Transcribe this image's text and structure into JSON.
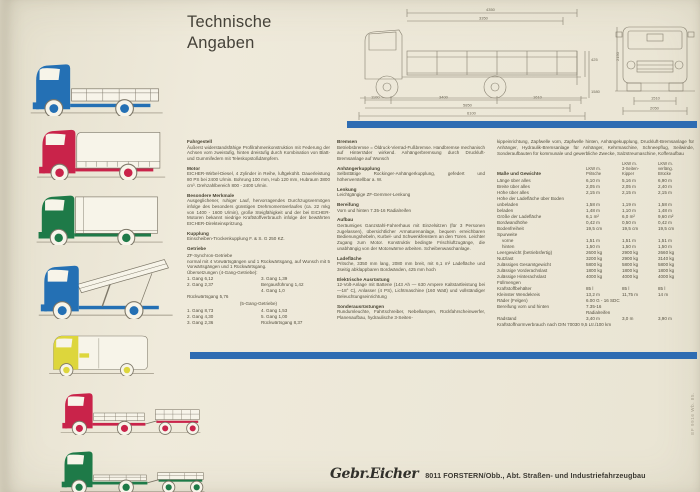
{
  "title": {
    "line1": "Technische",
    "line2": "Angaben"
  },
  "colors": {
    "blue": "#2470b4",
    "red": "#c9234a",
    "green": "#1e7a48",
    "yellow": "#ddd63c",
    "bar_blue": "#2e6cb2"
  },
  "trucks": [
    {
      "name": "Pritschenwagen",
      "color": "#2470b4"
    },
    {
      "name": "Planenwagen",
      "color": "#c9234a"
    },
    {
      "name": "Kofferwagen",
      "color": "#1e7a48"
    },
    {
      "name": "Dreiseitenkipper",
      "color": "#2470b4"
    },
    {
      "name": "Kastenwagen",
      "color": "#ddd63c"
    },
    {
      "name": "Pritschenzug",
      "color": "#c9234a"
    },
    {
      "name": "Plattformzug",
      "color": "#1e7a48"
    }
  ],
  "drawing": {
    "dims": {
      "top1": "4350",
      "top2": "3350",
      "side1": "425",
      "side2": "1580",
      "b1": "1100",
      "b2": "3400",
      "b3": "1610",
      "b4": "5850",
      "b5": "6100",
      "f_height": "2150",
      "f_track": "1510",
      "f_width": "2050"
    }
  },
  "col1": {
    "fahrgestell": {
      "heading": "Fahrgestell",
      "body": "Äußerst widerstandsfähige Profilrahmenkonstruktion mit Federung der Achsen vorn zweistufig, hinten dreistufig durch Kombination von Blatt- und Gummifedern mit Teleskopstoßdämpfern."
    },
    "motor": {
      "heading": "Motor",
      "body": "EICHER-Wirbel-Diesel, 4 Zylinder in Reihe, luftgekühlt. Dauerleistung 80 PS bei 2400 U/min. Bohrung 100 mm, Hub 120 mm, Hubraum 3800 cm³. Drehzahlbereich 800 - 2400 U/min."
    },
    "merkmale": {
      "heading": "Besondere Merkmale",
      "body": "Ausgeglichener, ruhiger Lauf, hervorragendes Durchzugsvermögen infolge des besonders günstigen Drehmomentverlaufes (ca. 22 mkg von 1400 - 1600 U/min), große Steigfähigkeit und der bei EICHER-Motoren bekannt niedrige Kraftstoffverbrauch infolge der bewährten EICHER-Direkteinspritzung."
    },
    "kupplung": {
      "heading": "Kupplung",
      "body": "Einscheiben-Trockenkupplung F. & S. G 250 KZ."
    },
    "getriebe": {
      "heading": "Getriebe",
      "intro1": "ZF-Synchron-Getriebe",
      "intro2": "normal mit 4 Vorwärtsgängen und 1 Rückwärtsgang, auf Wunsch mit 5 Vorwärtsgängen und 1 Rückwärtsgang.",
      "intro3": "Übersetzungen (4-Gang-Getriebe):",
      "g4_left": [
        "1. Gang 6,12",
        "2. Gang 2,37"
      ],
      "g4_right": [
        "3. Gang 1,39",
        "Bergausführung 1,42",
        "4. Gang 1,0"
      ],
      "reverse4": "Rückwärtsgang 5,76",
      "label5": "(5-Gang-Getriebe)",
      "g5_left": [
        "1. Gang 8,73",
        "2. Gang 4,30",
        "3. Gang 2,36"
      ],
      "g5_right": [
        "4. Gang 1,53",
        "5. Gang 1,00",
        "Rückwärtsgang 8,37"
      ]
    }
  },
  "col2": {
    "bremsen": {
      "heading": "Bremsen",
      "body": "Betriebsbremse = Öldruck-Vierrad-Fußbremse. Handbremse mechanisch auf Hinterräder wirkend. Anhängerbremsung durch Druckluft-Bremsanlage auf Wunsch"
    },
    "anhaengerkupplung": {
      "heading": "Anhängerkupplung",
      "body": "Selbsttätige Rockinger-Anhängerkupplung, gefedert und höhenverstellbar a. W."
    },
    "lenkung": {
      "heading": "Lenkung",
      "body": "Leichtgängige ZF-Gemmer-Lenkung"
    },
    "bereifung": {
      "heading": "Bereifung",
      "body": "Vorn und hinten 7.35-16 Radialreifen"
    },
    "aufbau": {
      "heading": "Aufbau",
      "body": "Geräumiges Ganzstahl-Fahrerhaus mit Einzelsitzen (für 3 Personen zugelassen), übersichtlicher Armaturenanlage, bequem erreichbaren Bedienungshebeln, Kurbel- und Schwenkfenstern an den Türen. Leichter Zugang zum Motor. Konstruktiv bedingte Frischluftzugänge, die unabhängig von der Motorwärme arbeiten. Scheibenwaschanlage."
    },
    "ladeflaeche": {
      "heading": "Ladefläche",
      "body": "Pritsche, 3350 mm lang, 2080 mm breit, mit 6,1 m² Ladefläche und 3seitig abklappbaren Bordwänden, 425 mm hoch"
    },
    "elektrik": {
      "heading": "Elektrische Ausrüstung",
      "body": "12-Volt-Anlage mit Batterie (143 Ah — 630 Ampere Kaltstartleistung bei —18° C), Anlasser (4 PS), Lichtmaschine (160 Watt) und vollständiger Beleuchtungseinrichtung"
    },
    "sonder": {
      "heading": "Sonderausrüstungen",
      "body": "Rundumleuchte, Fahrtschreiber, Nebellampen, Rückfahrscheinwerfer, Planenaufbau, hydraulische 3-Seiten-"
    }
  },
  "col3": {
    "continuation": "kippeinrichtung, Zapfwelle vorn, Zapfwelle hinten, Anhängekupplung, Druckluft-Bremsanlage für Anhänger, Hydraulik-Bremsanlage für Anhänger, Kehrmaschine, Schneepflug, Seilwinde, Sonderaufbauten für kommunale und gewerbliche Zwecke, Salzstreumaschine, Kofferaufbau",
    "table": {
      "section_title": "Maße und Gewichte",
      "headers": [
        "LKW m.\nPritsche",
        "LKW m.\n3-Seiten-\nKipper",
        "LKW m.\nverläng.\nBrücke"
      ],
      "rows": [
        {
          "l": "Länge über alles",
          "v": [
            "6,10 m",
            "5,16 m",
            "6,90 m"
          ]
        },
        {
          "l": "Breite über alles",
          "v": [
            "2,05 m",
            "2,05 m",
            "2,40 m"
          ]
        },
        {
          "l": "Höhe über alles",
          "v": [
            "2,15 m",
            "2,15 m",
            "2,15 m"
          ]
        },
        {
          "l": "Höhe der Ladefläche über Boden",
          "v": [
            "",
            "",
            ""
          ]
        },
        {
          "l": "unbeladen",
          "v": [
            "1,58 m",
            "1,19 m",
            "1,58 m"
          ]
        },
        {
          "l": "beladen",
          "v": [
            "1,48 m",
            "1,10 m",
            "1,48 m"
          ]
        },
        {
          "l": "Größe der Ladefläche",
          "v": [
            "6,1 m²",
            "6,0 m²",
            "9,60 m²"
          ]
        },
        {
          "l": "Bordwandhöhe",
          "v": [
            "0,42 m",
            "0,50 m",
            "0,42 m"
          ]
        },
        {
          "l": "Bodenfreiheit",
          "v": [
            "19,5 cm",
            "19,5 cm",
            "19,5 cm"
          ]
        },
        {
          "l": "Spurweite",
          "v": [
            "",
            "",
            ""
          ]
        },
        {
          "l": "vorne",
          "v": [
            "1,51 m",
            "1,51 m",
            "1,51 m"
          ],
          "indent": true
        },
        {
          "l": "hinten",
          "v": [
            "1,50 m",
            "1,50 m",
            "1,50 m"
          ],
          "indent": true
        },
        {
          "l": "Leergewicht (betriebsfertig)",
          "v": [
            "2600 kg",
            "2900 kg",
            "2660 kg"
          ]
        },
        {
          "l": "Nutzlast",
          "v": [
            "3200 kg",
            "2900 kg",
            "3140 kg"
          ]
        },
        {
          "l": "zulässiges Gesamtgewicht",
          "v": [
            "5800 kg",
            "5800 kg",
            "5800 kg"
          ]
        },
        {
          "l": "zulässige Vorderachslast",
          "v": [
            "1800 kg",
            "1800 kg",
            "1800 kg"
          ]
        },
        {
          "l": "zulässige Hinterachslast",
          "v": [
            "4000 kg",
            "4000 kg",
            "4000 kg"
          ]
        },
        {
          "l": "Füllmengen",
          "v": [
            "",
            "",
            ""
          ]
        },
        {
          "l": "Kraftstoffbehälter",
          "v": [
            "85 l",
            "85 l",
            "85 l"
          ]
        },
        {
          "l": "Kleinster Wendekreis",
          "v": [
            "13,2 m",
            "11,75 m",
            "14 m"
          ]
        },
        {
          "l": "Räder (Felgen)",
          "span": "6.00 G - 16 SDC"
        },
        {
          "l": "Bereifung vorn und hinten",
          "span": "7.35-16\nRadialreifen"
        },
        {
          "l": "Radstand",
          "v": [
            "3,40 m",
            "3,0 m",
            "3,90 m"
          ]
        },
        {
          "l": "Kraftstoffnormverbrauch nach DIN 70030 9,5 Ltr./100 km",
          "full": true
        }
      ]
    }
  },
  "footer": {
    "brand": "Gebr.Eicher",
    "address": "8011 FORSTERN/Obb., Abt. Straßen- und Industriefahrzeugbau"
  },
  "edge_note": "EF 9916 Wb. 85."
}
